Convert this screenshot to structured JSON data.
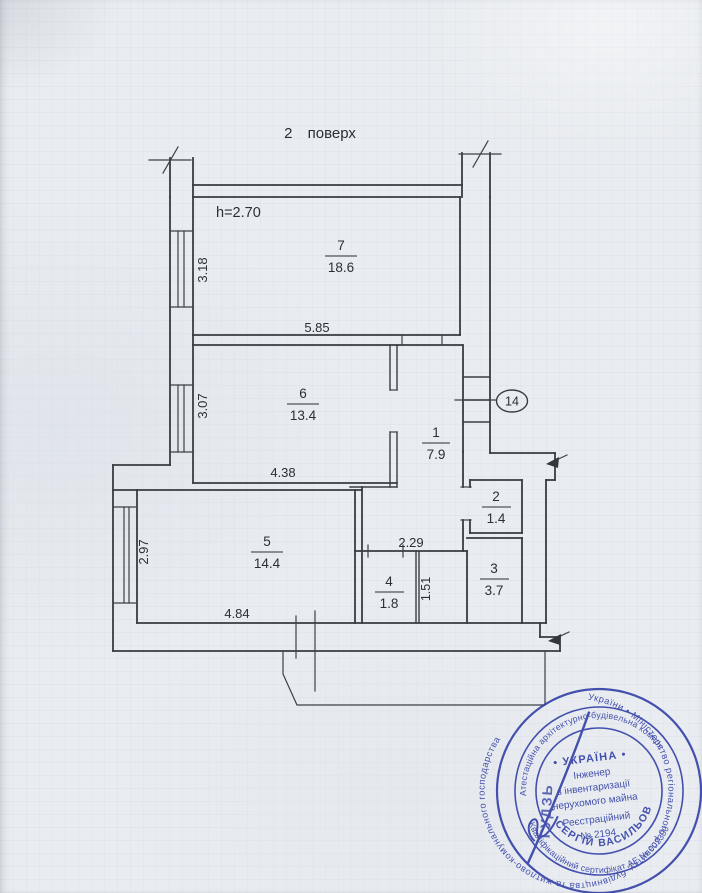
{
  "page": {
    "title": "2 поверх",
    "height_note": "h=2.70"
  },
  "rooms": {
    "r7": {
      "number": "7",
      "area": "18.6"
    },
    "r6": {
      "number": "6",
      "area": "13.4"
    },
    "r1": {
      "number": "1",
      "area": "7.9"
    },
    "r2": {
      "number": "2",
      "area": "1.4"
    },
    "r3": {
      "number": "3",
      "area": "3.7"
    },
    "r4": {
      "number": "4",
      "area": "1.8"
    },
    "r5": {
      "number": "5",
      "area": "14.4"
    }
  },
  "dimensions": {
    "room7_width": "5.85",
    "room7_depth": "3.18",
    "room6_width": "4.38",
    "room6_depth": "3.07",
    "room5_width": "4.84",
    "room5_depth": "2.97",
    "hall_width": "2.29",
    "hall_depth": "1.51"
  },
  "callout_14": "14",
  "stamp": {
    "ring_outer": "України  •  Міністерство регіонального розвитку, будівництва та житлово-комунального господарства",
    "ring_middle_top": "Атестаційна архітектурно-будівельна комісія",
    "ring_middle_bottom": "Кваліфікаційний сертифікат АЕ № 002300",
    "country": "• УКРАЇНА •",
    "line1": "Інженер",
    "line2": "з інвентаризації",
    "line3": "нерухомого майна",
    "line4": "Реєстраційний",
    "line5": "№ 2194",
    "name_arc": "СЕРГІЙ ВАСИЛЬОВИЧ",
    "surname": "ГУДЗЬ",
    "ink_color": "#2d3ba4"
  },
  "colors": {
    "paper": "#e9ecf0",
    "drawing_line": "#383c42"
  }
}
